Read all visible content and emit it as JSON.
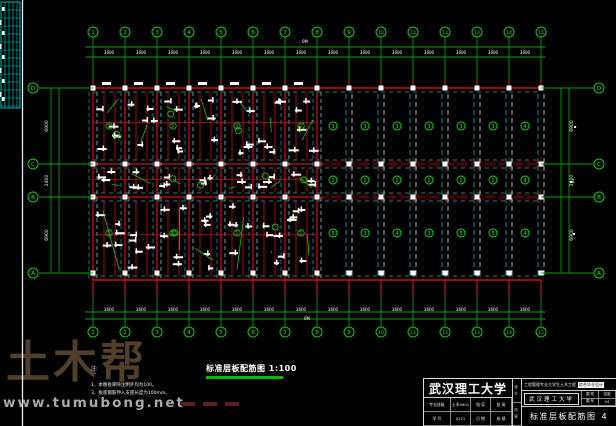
{
  "watermark": {
    "logo": "土木帮",
    "url": "www.tumubong.net"
  },
  "drawing_title": {
    "text": "标准层板配筋图",
    "scale": "1:100"
  },
  "notes": {
    "heading": "注:",
    "lines": [
      "1、本图板厚除注明外均为100。",
      "3、板底钢筋伸入支座长度为100mm。"
    ]
  },
  "title_block": {
    "university": "武汉理工大学",
    "project_a": "工程管理专业大学生土木工程",
    "project_b": "综合毕业设计",
    "rows": [
      [
        "专业班级",
        "土木0901",
        "指 导",
        "批 阅"
      ],
      [
        "学    号",
        "0121",
        "日 期",
        "成 绩"
      ]
    ],
    "side_top": "设 计",
    "side_bottom": "内 容",
    "school_box": "武汉理工大学",
    "cells": [
      [
        "图 别",
        "结施"
      ],
      [
        "图 号",
        "04"
      ]
    ],
    "sheet_title": "标准层板配筋图",
    "sheet_no": "4"
  },
  "plan": {
    "columns": [
      "1",
      "2",
      "3",
      "4",
      "5",
      "6",
      "7",
      "8",
      "9",
      "10",
      "11",
      "12",
      "13",
      "14",
      "15"
    ],
    "col_x0": 93,
    "col_dx": 32,
    "rows": [
      {
        "label": "D",
        "y": 88
      },
      {
        "label": "C",
        "y": 164
      },
      {
        "label": "B",
        "y": 197
      },
      {
        "label": "A",
        "y": 273
      }
    ],
    "bay_dim": "3600",
    "left_dims": [
      "6900",
      "2400",
      "6900"
    ],
    "right_dims": [
      "6900",
      "2400",
      "6900"
    ],
    "cell_marks": {
      "rows_y": [
        126,
        180,
        233
      ],
      "values": [
        [
          "3",
          "3",
          "3",
          "3",
          "3",
          "3",
          "4"
        ],
        [
          "1",
          "1",
          "1",
          "1",
          "1",
          "1",
          "4"
        ],
        [
          "5",
          "3",
          "4",
          "3",
          "5",
          "5",
          "4"
        ]
      ]
    },
    "left_marks": {
      "rows_y": [
        126,
        233
      ],
      "values": [
        [
          "2",
          "1",
          "2",
          "1",
          "2",
          "1",
          "2"
        ],
        [
          "1",
          "2",
          "1",
          "2",
          "1",
          "2",
          "1"
        ]
      ]
    },
    "misc_labels": [
      {
        "t": "0M",
        "x": 305,
        "y": 43
      },
      {
        "t": "0M",
        "x": 307,
        "y": 320
      },
      {
        "t": "▪",
        "x": 575,
        "y": 128
      },
      {
        "t": "▪1",
        "x": 572,
        "y": 183
      },
      {
        "t": "▪",
        "x": 574,
        "y": 235
      }
    ],
    "colors": {
      "green": "#00a400",
      "bright": "#00e400",
      "label": "#00ff00",
      "red": "#cf1010",
      "dark_red": "#8b0000",
      "cyan": "#00b6b6",
      "pale": "#9fd8d8",
      "white": "#ffffff",
      "frame": "#e8e8e8"
    }
  }
}
